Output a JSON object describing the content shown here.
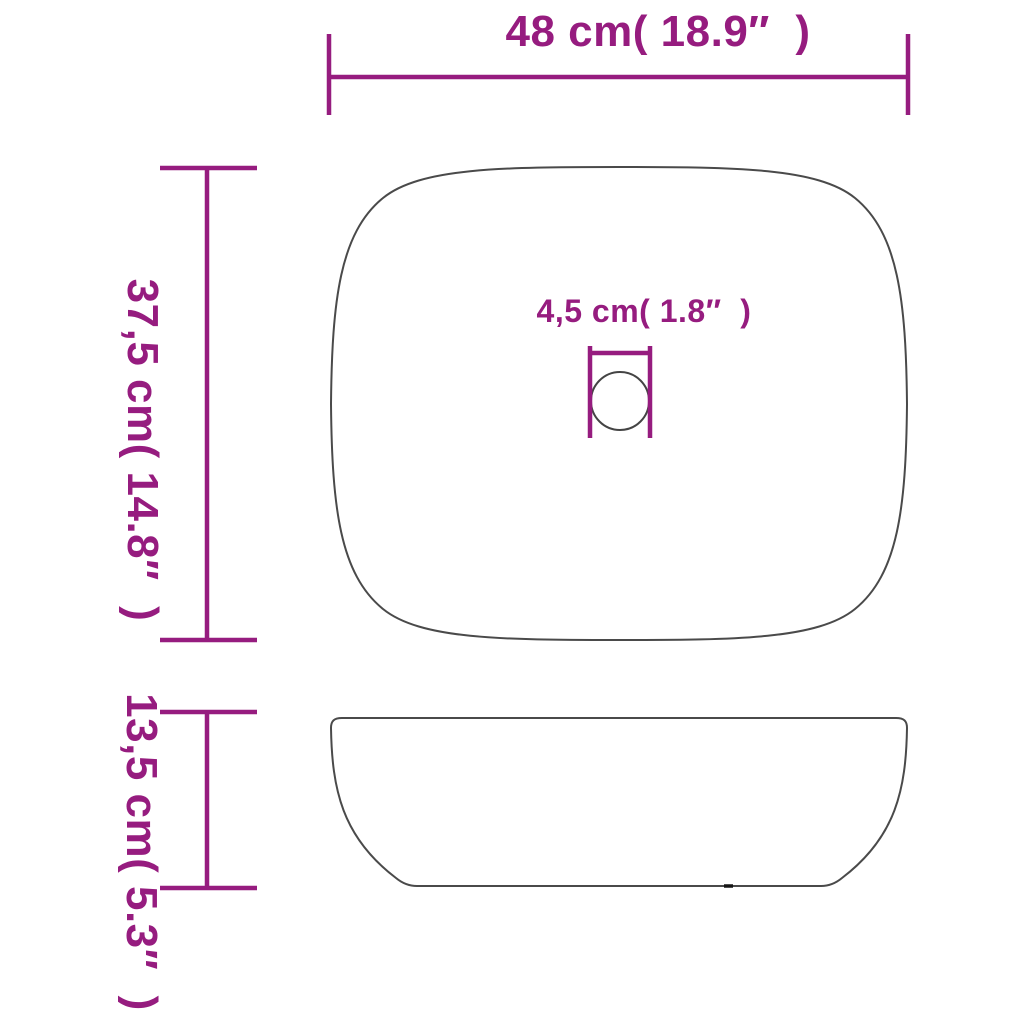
{
  "diagram": {
    "type": "product-dimension-drawing",
    "subject": "rectangular countertop washbasin, top view and side view"
  },
  "colors": {
    "dimension_magenta": "#961c7f",
    "outline_gray": "#4a4a4a",
    "drain_outline_gray": "#444444",
    "bottom_mark_black": "#151515",
    "background": "#ffffff"
  },
  "dimensions": {
    "width": {
      "label": "48 cm( 18.9″  )",
      "cm": "48",
      "inches": "18.9"
    },
    "depth": {
      "label": "37,5 cm( 14.8″  )",
      "cm": "37,5",
      "inches": "14.8"
    },
    "drain_diameter": {
      "label": "4,5 cm( 1.8″  )",
      "cm": "4,5",
      "inches": "1.8"
    },
    "height": {
      "label": "13,5 cm( 5.3″  )",
      "cm": "13,5",
      "inches": "5.3"
    }
  }
}
